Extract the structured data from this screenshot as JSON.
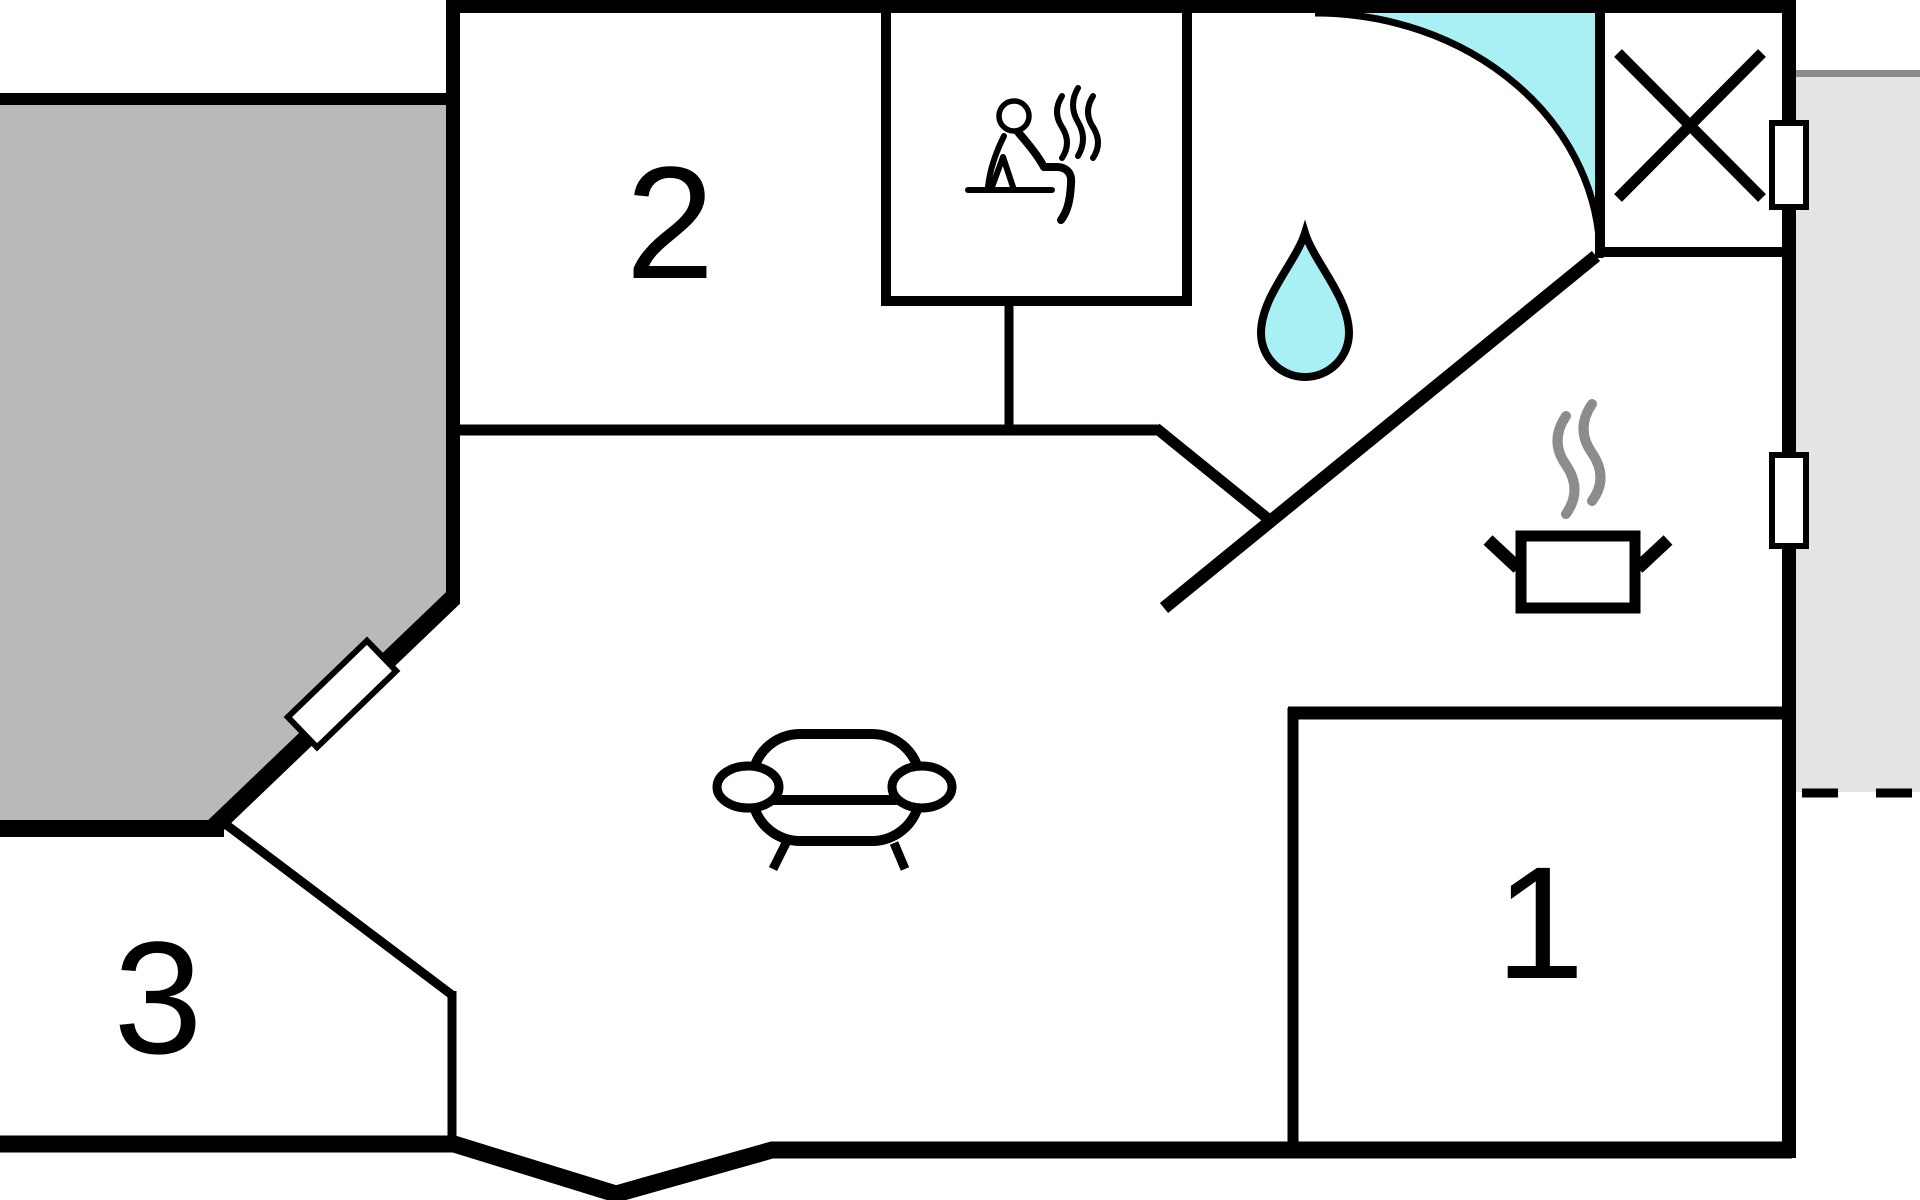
{
  "plan": {
    "kind": "vacation-house floor plan",
    "rooms": [
      {
        "id": "room-1",
        "label": "1"
      },
      {
        "id": "room-2",
        "label": "2"
      },
      {
        "id": "room-3",
        "label": "3"
      }
    ],
    "icons": [
      "sauna-person-icon",
      "steam-icon",
      "water-drop-icon",
      "cooking-pot-icon",
      "sofa-icon",
      "door-swing-icon",
      "crossed-box-icon",
      "window-icon"
    ],
    "colors": {
      "wall_black": "#000000",
      "terrace_gray": "#b9b9b9",
      "exterior_gray": "#e4e4e4",
      "exterior_edge_gray": "#8c8c8c",
      "water_cyan": "#a8f0f4",
      "steam_gray": "#8c8c8c",
      "background_white": "#ffffff"
    }
  }
}
